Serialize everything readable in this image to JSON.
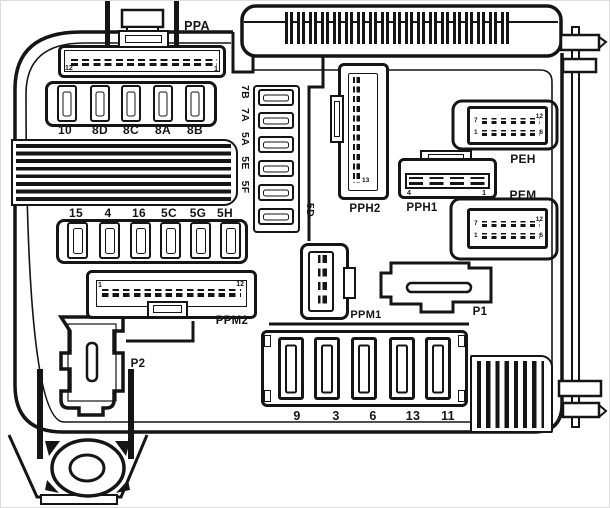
{
  "connector_labels": {
    "ppa": "PPA",
    "pph2": "PPH2",
    "pph1": "PPH1",
    "peh": "PEH",
    "pem": "PEM",
    "ppm1": "PPM1",
    "p1": "P1",
    "ppm2": "PPM2",
    "p2": "P2"
  },
  "fuses": {
    "top_row": [
      "10",
      "8D",
      "8C",
      "8A",
      "8B"
    ],
    "middle_row": [
      "15",
      "4",
      "16",
      "5C",
      "5G",
      "5H"
    ],
    "vertical_column": [
      "7B",
      "7A",
      "5A",
      "5E",
      "5F",
      "5D"
    ],
    "bottom_row": [
      "9",
      "3",
      "6",
      "13",
      "11"
    ]
  },
  "pin_numbers": {
    "ppa": {
      "left": "12",
      "right": "1"
    },
    "pph2": {
      "bottom": "13"
    },
    "pph1": {
      "left": "4",
      "right": "1"
    },
    "peh": {
      "top_left": "7",
      "top_right": "12",
      "bottom_left": "1",
      "bottom_right": "6"
    },
    "pem": {
      "top_left": "7",
      "top_right": "12",
      "bottom_left": "1",
      "bottom_right": "6"
    },
    "ppm2": {
      "left": "1",
      "right": "12"
    }
  },
  "colors": {
    "line": "#151515",
    "background": "#ffffff"
  }
}
